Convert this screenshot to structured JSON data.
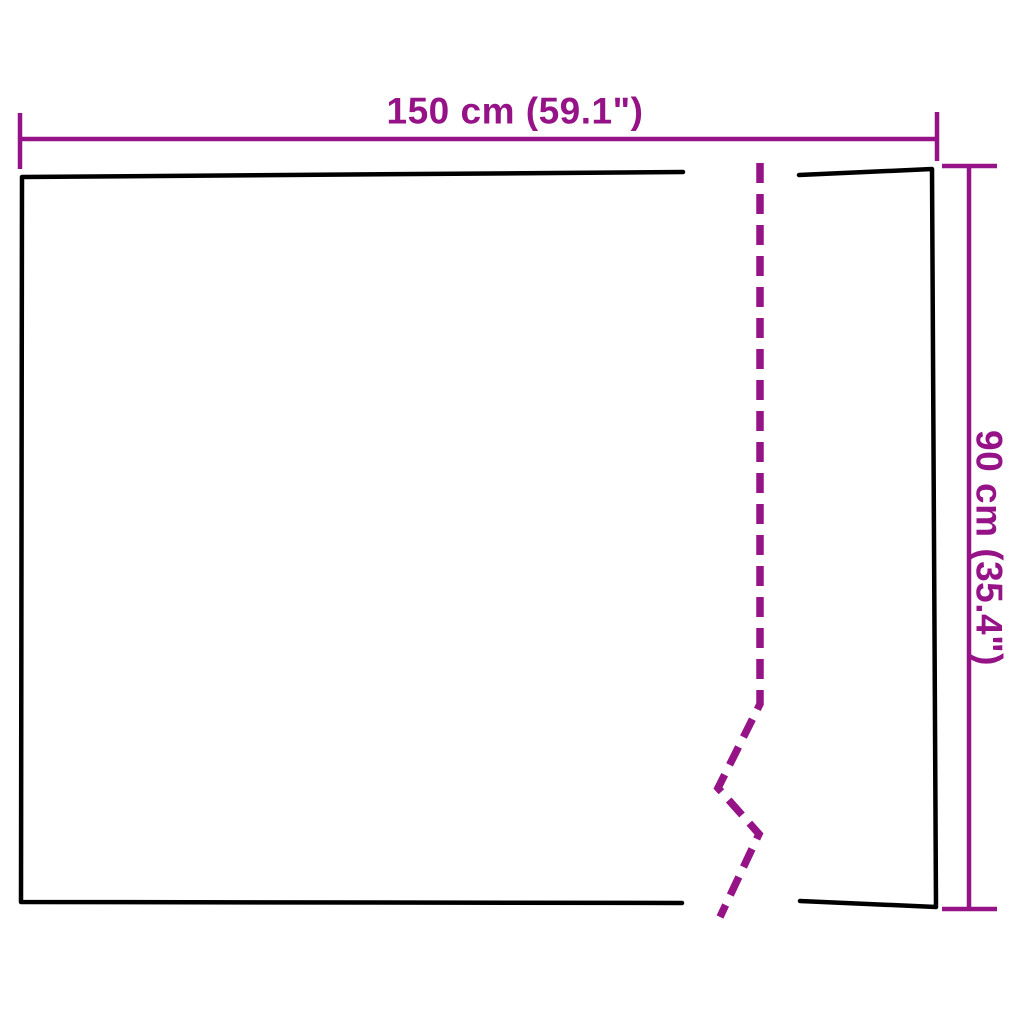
{
  "diagram": {
    "type": "product-dimension-drawing",
    "width_label": "150 cm (59.1\")",
    "height_label": "90 cm (35.4\")"
  },
  "colors": {
    "dimension": "#951287",
    "outline": "#000000",
    "background": "#ffffff"
  }
}
